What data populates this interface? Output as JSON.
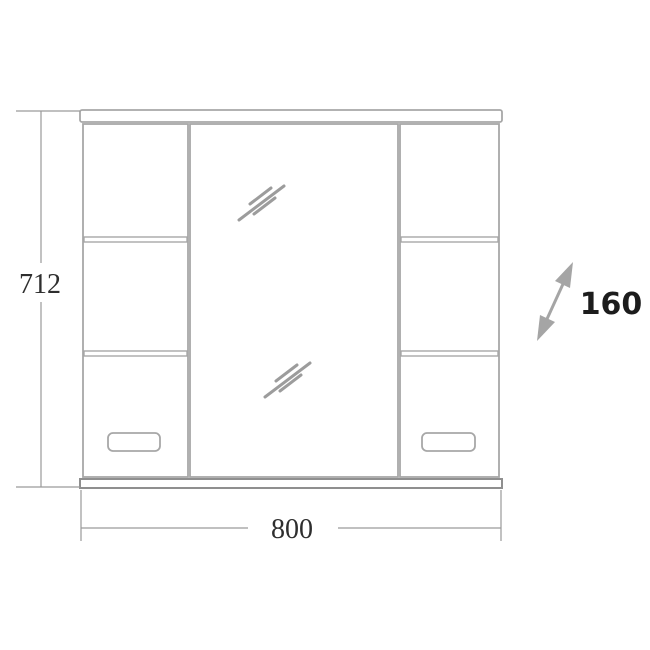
{
  "figure": {
    "type": "technical-drawing",
    "subject": "mirror cabinet front elevation with dimensions",
    "dimensions": {
      "height": "712",
      "width": "800",
      "depth": "160"
    },
    "colors": {
      "outline": "#a7a7a7",
      "outline_dark": "#8f8f8f",
      "glass_mark": "#9c9c9c",
      "dimension_line": "#9a9a9a",
      "dimension_text": "#2e2e2e",
      "depth_text": "#1c1c1c",
      "arrow": "#a5a5a5",
      "background": "#ffffff"
    }
  }
}
